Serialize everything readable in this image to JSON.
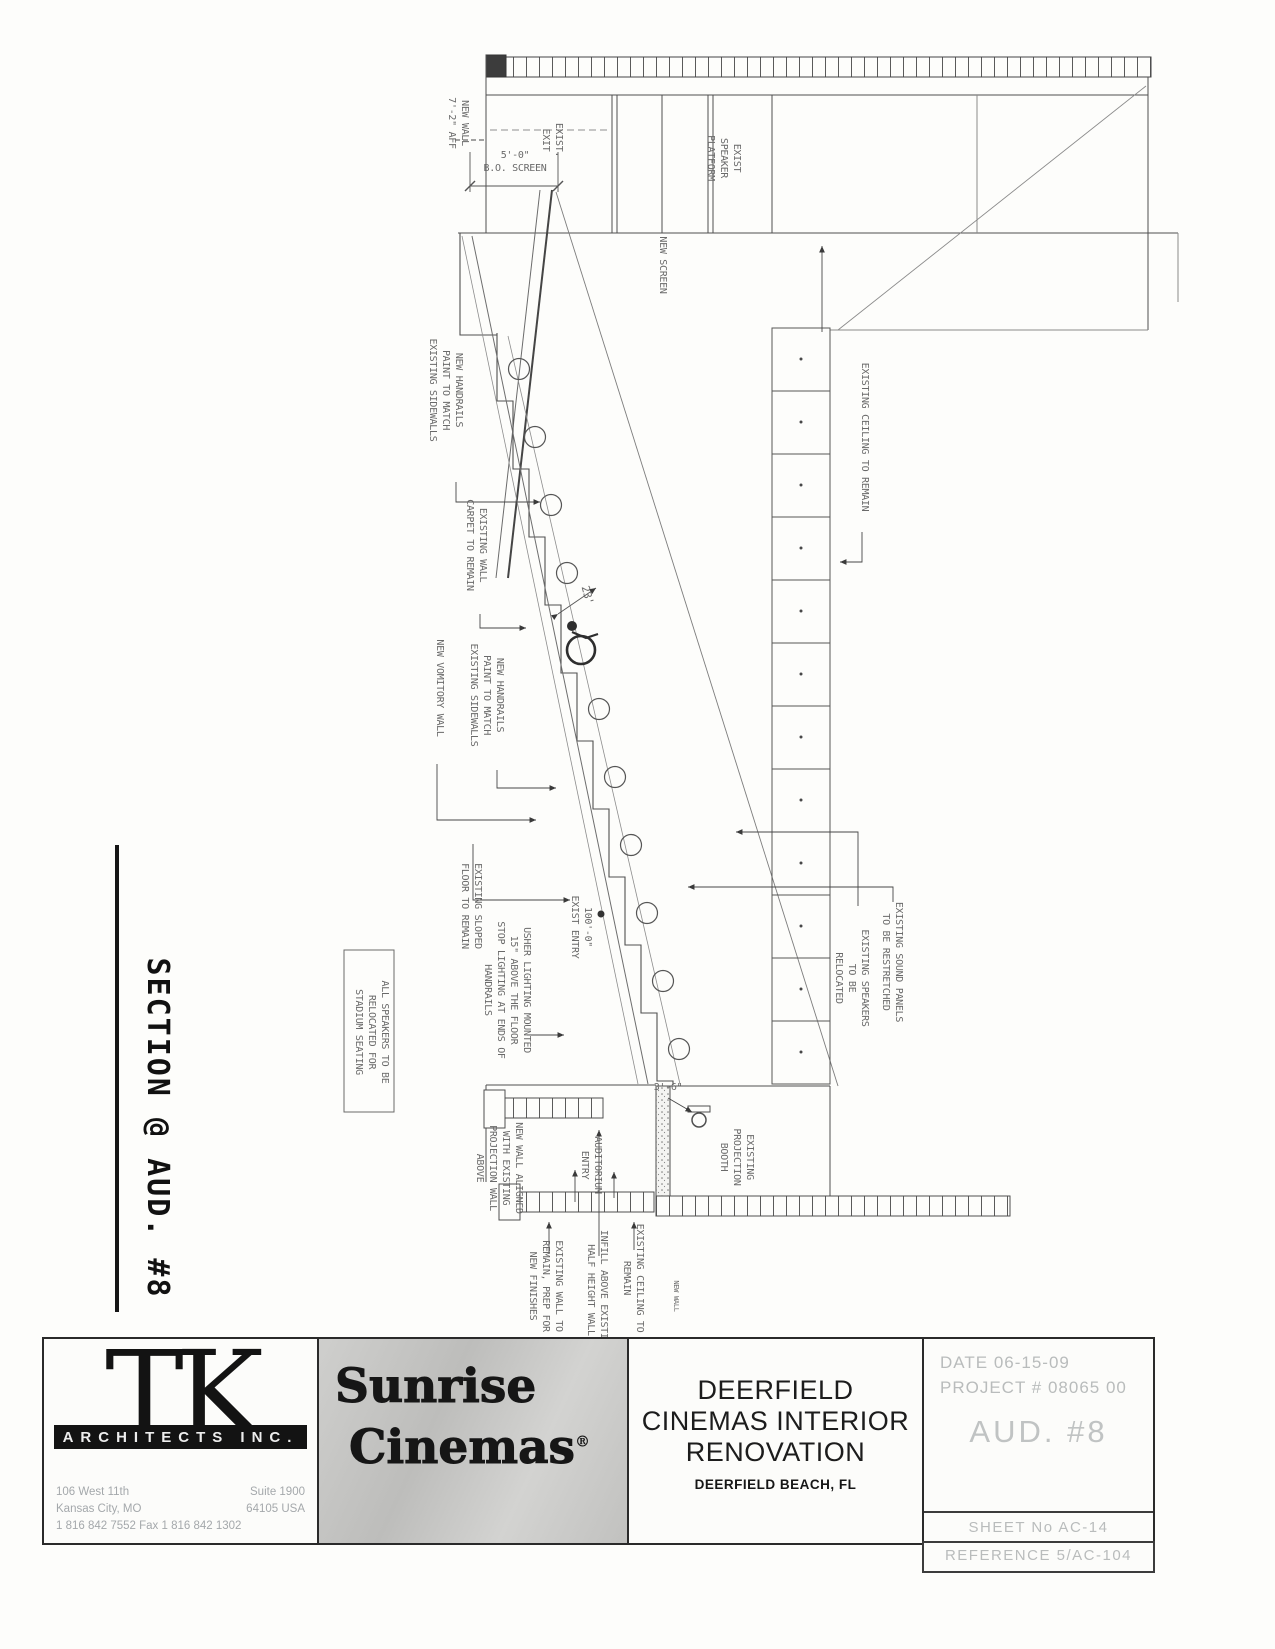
{
  "section_title": {
    "text": "SECTION @ AUD. #8"
  },
  "drawing": {
    "labels": [
      {
        "id": "new-wall-aff",
        "t": "NEW WALL\n7'-2\" AFF",
        "x": 462,
        "y": 123,
        "r": 90,
        "s": 10
      },
      {
        "id": "exist-exit",
        "t": "EXIST.\nEXIT",
        "x": 556,
        "y": 140,
        "r": 90,
        "s": 10
      },
      {
        "id": "exist-speaker-platform",
        "t": "EXIST\nSPEAKER\nPLATFORM",
        "x": 734,
        "y": 158,
        "r": 90,
        "s": 10
      },
      {
        "id": "bo-screen-dim",
        "t": "5'-0\"\nB.O. SCREEN",
        "x": 515,
        "y": 158,
        "r": 0,
        "s": 10
      },
      {
        "id": "new-screen",
        "t": "NEW SCREEN",
        "x": 660,
        "y": 265,
        "r": 90,
        "s": 10
      },
      {
        "id": "new-handrails-upper",
        "t": "NEW HANDRAILS\nPAINT TO MATCH\nEXISTING SIDEWALLS",
        "x": 456,
        "y": 390,
        "r": 90,
        "s": 10
      },
      {
        "id": "existing-wall-carpet",
        "t": "EXISTING WALL\nCARPET TO REMAIN",
        "x": 480,
        "y": 545,
        "r": 90,
        "s": 10
      },
      {
        "id": "new-vomitory-wall",
        "t": "NEW VOMITORY WALL",
        "x": 437,
        "y": 688,
        "r": 90,
        "s": 10
      },
      {
        "id": "new-handrails-lower",
        "t": "NEW HANDRAILS\nPAINT TO MATCH\nEXISTING SIDEWALLS",
        "x": 497,
        "y": 695,
        "r": 90,
        "s": 10
      },
      {
        "id": "dim-23",
        "t": "23'",
        "x": 584,
        "y": 596,
        "r": 75,
        "s": 11
      },
      {
        "id": "existing-sloped-floor",
        "t": "EXISTING SLOPED\nFLOOR TO REMAIN",
        "x": 475,
        "y": 906,
        "r": 90,
        "s": 10
      },
      {
        "id": "exist-entry-elev",
        "t": "100'-0\"\nEXIST ENTRY",
        "x": 585,
        "y": 927,
        "r": 90,
        "s": 10
      },
      {
        "id": "usher-lighting-note",
        "t": "USHER LIGHTING MOUNTED\n15\" ABOVE THE FLOOR\nSTOP LIGHTING AT ENDS OF\nHANDRAILS",
        "x": 524,
        "y": 990,
        "r": 90,
        "s": 10
      },
      {
        "id": "speakers-note",
        "t": "ALL SPEAKERS TO BE\nRELOCATED FOR\nSTADIUM SEATING",
        "x": 382,
        "y": 1032,
        "r": 90,
        "s": 10
      },
      {
        "id": "new-wall-aligned",
        "t": "NEW WALL ALIGNED\nWITH EXISTING\nPROJECTION WALL\nABOVE",
        "x": 516,
        "y": 1168,
        "r": 90,
        "s": 10
      },
      {
        "id": "auditorium-entry",
        "t": "AUDITORIUM\nENTRY",
        "x": 595,
        "y": 1165,
        "r": 90,
        "s": 10
      },
      {
        "id": "existing-projection-booth",
        "t": "EXISTING\nPROJECTION\nBOOTH",
        "x": 747,
        "y": 1157,
        "r": 90,
        "s": 10
      },
      {
        "id": "existing-wall-remain",
        "t": "EXISTING WALL TO\nREMAIN, PREP FOR\nNEW FINISHES",
        "x": 556,
        "y": 1286,
        "r": 90,
        "s": 10
      },
      {
        "id": "infill-half-height",
        "t": "INFILL ABOVE EXISTING\nHALF HEIGHT WALL",
        "x": 601,
        "y": 1290,
        "r": 90,
        "s": 10
      },
      {
        "id": "existing-ceiling-bottom",
        "t": "EXISTING CEILING TO\nREMAIN",
        "x": 637,
        "y": 1278,
        "r": 90,
        "s": 10
      },
      {
        "id": "existing-ceiling-right",
        "t": "EXISTING CEILING TO REMAIN",
        "x": 862,
        "y": 437,
        "r": 90,
        "s": 10
      },
      {
        "id": "existing-speakers-relocated",
        "t": "EXISTING SPEAKERS\nTO BE\nRELOCATED",
        "x": 862,
        "y": 978,
        "r": 90,
        "s": 10
      },
      {
        "id": "existing-sound-panels",
        "t": "EXISTING SOUND PANELS\nTO BE RESTRETCHED",
        "x": 896,
        "y": 962,
        "r": 90,
        "s": 10
      },
      {
        "id": "dim-3-6",
        "t": "3'-6\"",
        "x": 668,
        "y": 1090,
        "r": 0,
        "s": 10
      },
      {
        "id": "new-wall-small",
        "t": "NEW WALL",
        "x": 674,
        "y": 1296,
        "r": 90,
        "s": 7
      }
    ]
  },
  "title_block": {
    "architect": {
      "initials": "TK",
      "banner": "ARCHITECTS INC.",
      "address_rows": [
        {
          "left": "106 West 11th",
          "right": "Suite 1900"
        },
        {
          "left": "Kansas City, MO",
          "right": "64105 USA"
        }
      ],
      "phone": "1 816 842 7552 Fax 1 816 842 1302"
    },
    "brand": {
      "line1": "Sunrise",
      "line2": "Cinemas",
      "reg": "®"
    },
    "project": {
      "line1": "DEERFIELD",
      "line2": "CINEMAS INTERIOR",
      "line3": "RENOVATION",
      "location": "DEERFIELD BEACH, FL"
    },
    "meta": {
      "date_label": "DATE",
      "date": "06-15-09",
      "project_label": "PROJECT #",
      "project_no": "08065 00",
      "aud": "AUD. #8",
      "sheet": "SHEET No AC-14",
      "reference": "REFERENCE 5/AC-104"
    }
  },
  "colors": {
    "line": "#4f4f4f",
    "faded_line": "#878787",
    "label_text": "#6a6a6a",
    "title_text": "#111111",
    "meta_text": "#b9bcbc"
  }
}
